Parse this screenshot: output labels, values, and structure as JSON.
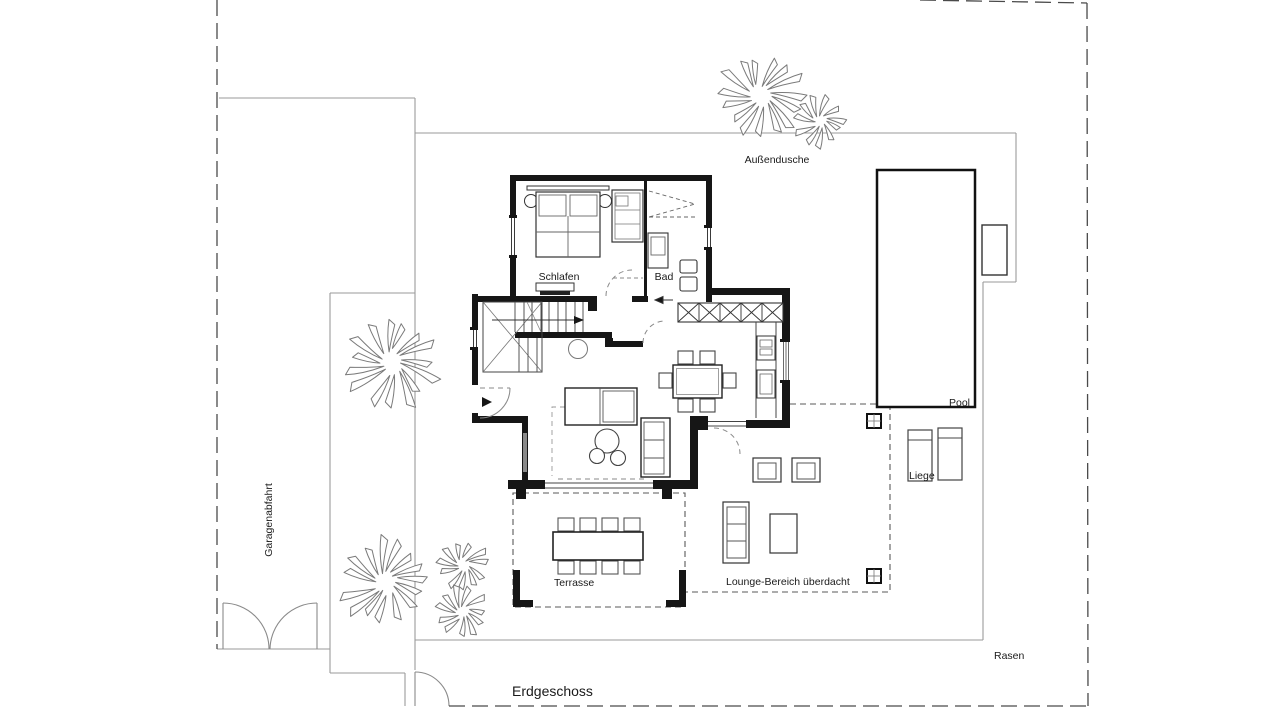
{
  "title": "Erdgeschoss",
  "labels": {
    "aussendusche": "Außendusche",
    "schlafen": "Schlafen",
    "bad": "Bad",
    "pool": "Pool",
    "liege": "Liege",
    "terrasse": "Terrasse",
    "lounge": "Lounge-Bereich überdacht",
    "garagenabfahrt": "Garagenabfahrt",
    "rasen": "Rasen",
    "erdgeschoss": "Erdgeschoss"
  },
  "areas": [
    "Schlafen",
    "Bad",
    "Terrasse",
    "Lounge-Bereich überdacht",
    "Pool",
    "Liege",
    "Außendusche",
    "Garagenabfahrt",
    "Rasen"
  ],
  "colors": {
    "background": "#ffffff",
    "wall": "#161616",
    "site_line": "#9a9a9a",
    "boundary": "#4a4a4a",
    "dashed_area": "#5a5a5a",
    "furniture": "#333333",
    "tree_outline": "#7a7a7a",
    "text": "#1a1a1a"
  }
}
